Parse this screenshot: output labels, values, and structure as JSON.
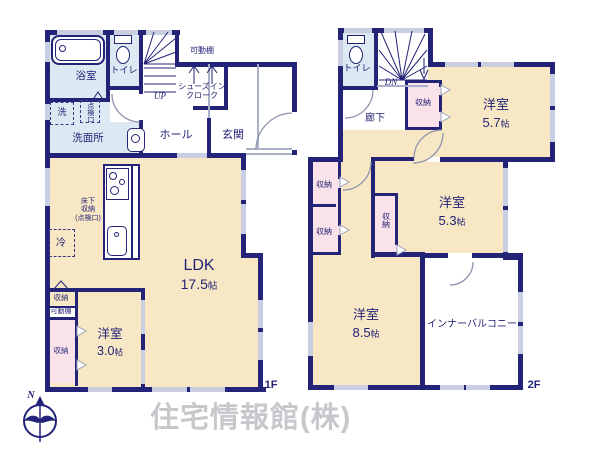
{
  "colors": {
    "wall": "#232377",
    "tatami_room": "#f7e7c4",
    "wet_room": "#dce8f2",
    "closet": "#f9e2e9",
    "window": "#c9cfe0",
    "watermark": "#c7c7cc"
  },
  "f1": {
    "floor_label": "1F",
    "bath": "浴室",
    "toilet": "トイレ",
    "washer": "洗",
    "hatch": "点検口",
    "washroom": "洗面所",
    "hall": "ホール",
    "entrance": "玄関",
    "shoes_closet_line1": "シューズイン",
    "shoes_closet_line2": "クローク",
    "movable_shelf": "可動棚",
    "stairs": "UP",
    "ldk_name": "LDK",
    "ldk_size": "17.5",
    "ldk_unit": "帖",
    "floor_storage_line1": "床下",
    "floor_storage_line2": "収納",
    "floor_storage_line3": "(点検口)",
    "fridge": "冷",
    "closet_top": "収納",
    "movable_shelf2": "可動棚",
    "closet_bottom": "収納",
    "bedroom_name": "洋室",
    "bedroom_size": "3.0",
    "bedroom_unit": "帖"
  },
  "f2": {
    "floor_label": "2F",
    "toilet": "トイレ",
    "stairs": "DN",
    "corridor": "廊下",
    "closet_a": "収納",
    "closet_b": "収納",
    "closet_c": "収納",
    "closet_d": "収納",
    "bedroom57_name": "洋室",
    "bedroom57_size": "5.7",
    "bedroom57_unit": "帖",
    "bedroom53_name": "洋室",
    "bedroom53_size": "5.3",
    "bedroom53_unit": "帖",
    "bedroom85_name": "洋室",
    "bedroom85_size": "8.5",
    "bedroom85_unit": "帖",
    "balcony": "インナーバルコニー"
  },
  "footer": {
    "compass_north": "N",
    "company": "住宅情報館(株)"
  }
}
